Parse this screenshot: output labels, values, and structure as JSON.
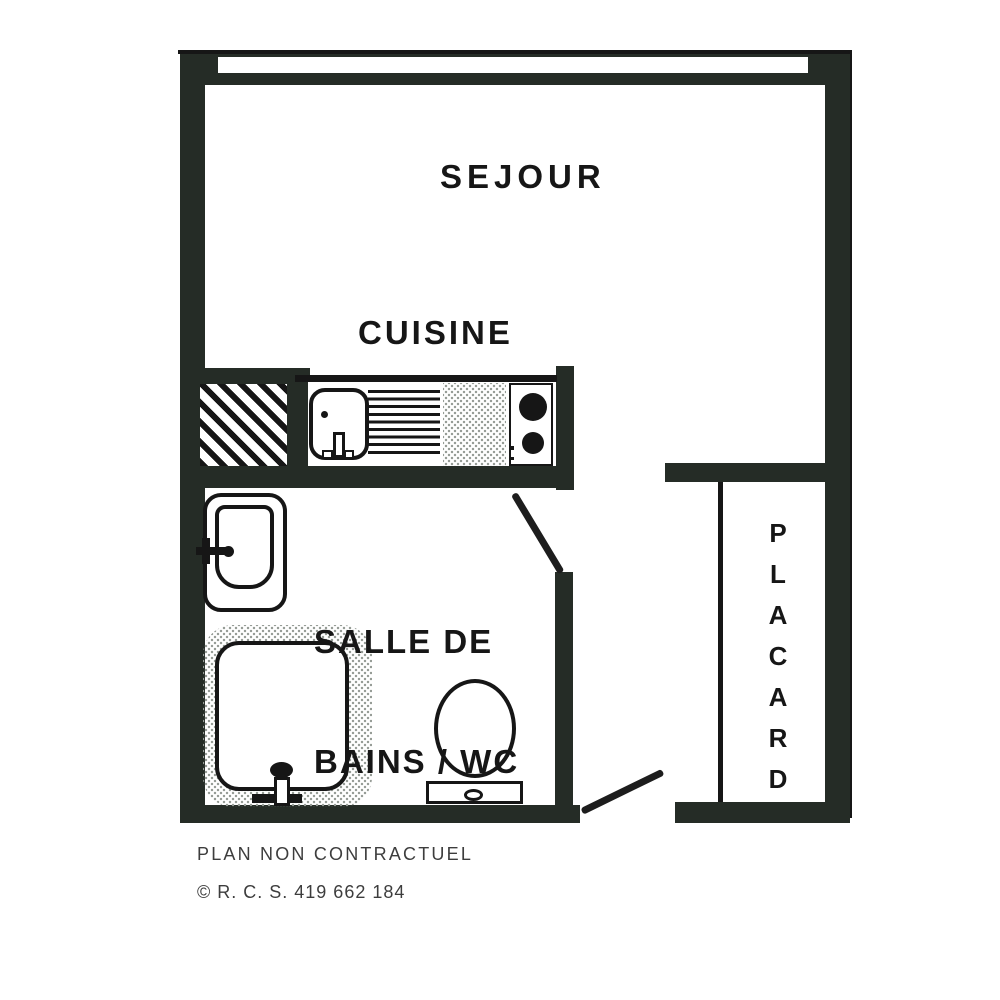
{
  "plan": {
    "rooms": {
      "sejour": "SEJOUR",
      "cuisine": "CUISINE",
      "salle_de_bains_line1": "SALLE DE",
      "salle_de_bains_line2": "BAINS / WC",
      "placard": "PLACARD"
    },
    "footer": {
      "disclaimer": "PLAN NON CONTRACTUEL",
      "registration": "© R. C. S. 419 662 184"
    },
    "colors": {
      "wall": "#252c26",
      "ink": "#161616",
      "paper": "#ffffff",
      "stipple": "#979d97",
      "footer_ink": "#3d3d3d"
    }
  }
}
